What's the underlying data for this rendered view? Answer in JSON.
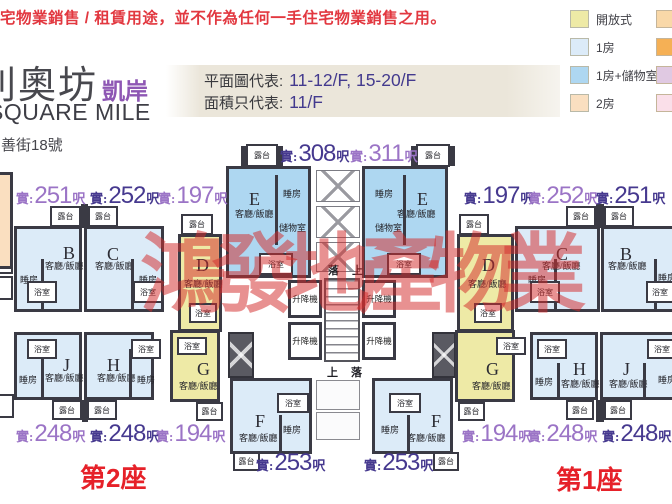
{
  "disclaimer": "宅物業銷售 / 租賃用途，並不作為任何一手住宅物業銷售之用。",
  "header": {
    "title_zh": "利奧坊",
    "title_accent": "凱岸",
    "title_en": "SQUARE MILE",
    "address": "善街18號"
  },
  "info_box": {
    "row1_label": "平面圖代表:",
    "row1_value": "11-12/F, 15-20/F",
    "row2_label": "面積只代表:",
    "row2_value": "11/F"
  },
  "legend": {
    "items": [
      {
        "label": "開放式",
        "color": "#eeeaa6"
      },
      {
        "label": "1房",
        "color": "#dcebf8"
      },
      {
        "label": "1房+儲物室",
        "color": "#aed7f1"
      },
      {
        "label": "2房",
        "color": "#fadfc0"
      }
    ],
    "extra_swatches": [
      "#f9d8a8",
      "#f5b055",
      "#e0c9e2",
      "#fadfe9"
    ]
  },
  "watermark": "鴻發地產物業",
  "plan": {
    "room_labels": {
      "living": "客廳/飯廳",
      "bed": "睡房",
      "bath": "浴室",
      "store": "儲物室",
      "balcony": "露台",
      "lift": "升降機",
      "up": "上",
      "down": "落"
    },
    "area_prefix": "實:",
    "area_suffix": "呎",
    "colors": {
      "open": "#eeeaa6",
      "one_bed": "#dcebf8",
      "one_bed_store": "#aed7f1",
      "two_bed": "#fadfc0",
      "wall": "#3a3a44",
      "area_light": "#9b74c6",
      "area_dark": "#46398f"
    },
    "units": [
      {
        "id": "a2",
        "letter": "",
        "type": "two_bed",
        "area": "",
        "tone": ""
      },
      {
        "id": "b2",
        "letter": "B",
        "type": "one_bed",
        "area": "251",
        "tone": "light"
      },
      {
        "id": "c2",
        "letter": "C",
        "type": "one_bed",
        "area": "252",
        "tone": "dark"
      },
      {
        "id": "d2",
        "letter": "D",
        "type": "open",
        "area": "197",
        "tone": "light"
      },
      {
        "id": "e2",
        "letter": "E",
        "type": "one_bed_store",
        "area": "308",
        "tone": "dark"
      },
      {
        "id": "e1",
        "letter": "E",
        "type": "one_bed_store",
        "area": "311",
        "tone": "light"
      },
      {
        "id": "d1",
        "letter": "D",
        "type": "open",
        "area": "197",
        "tone": "dark"
      },
      {
        "id": "c1",
        "letter": "C",
        "type": "one_bed",
        "area": "252",
        "tone": "light"
      },
      {
        "id": "b1",
        "letter": "B",
        "type": "one_bed",
        "area": "251",
        "tone": "dark"
      },
      {
        "id": "j2",
        "letter": "J",
        "type": "one_bed",
        "area": "248",
        "tone": "light"
      },
      {
        "id": "h2",
        "letter": "H",
        "type": "one_bed",
        "area": "248",
        "tone": "dark"
      },
      {
        "id": "g2",
        "letter": "G",
        "type": "open",
        "area": "194",
        "tone": "light"
      },
      {
        "id": "f2",
        "letter": "F",
        "type": "one_bed",
        "area": "253",
        "tone": "dark"
      },
      {
        "id": "f1",
        "letter": "F",
        "type": "one_bed",
        "area": "253",
        "tone": "dark"
      },
      {
        "id": "g1",
        "letter": "G",
        "type": "open",
        "area": "194",
        "tone": "light"
      },
      {
        "id": "h1",
        "letter": "H",
        "type": "one_bed",
        "area": "248",
        "tone": "light"
      },
      {
        "id": "j1",
        "letter": "J",
        "type": "one_bed",
        "area": "248",
        "tone": "dark"
      }
    ],
    "towers": [
      {
        "label": "第2座"
      },
      {
        "label": "第1座"
      }
    ]
  }
}
